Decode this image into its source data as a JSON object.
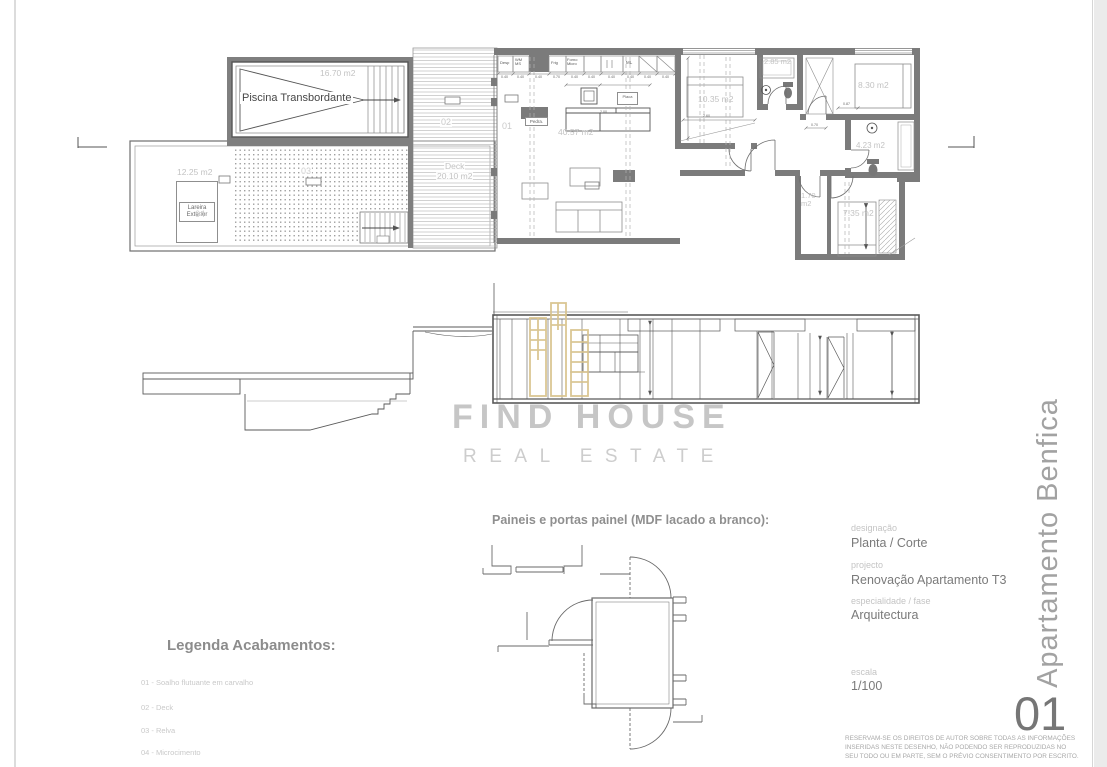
{
  "colors": {
    "watermark_gold": "#d9c48f",
    "wall_gray": "#7b7b7b",
    "line_dark": "#555555",
    "label_light": "#c3c3c3"
  },
  "watermark": {
    "brand_line1": "FIND HOUSE",
    "brand_line2": "REAL ESTATE"
  },
  "sheet": {
    "number": "01",
    "project_vertical": "Apartamento Benfica"
  },
  "title_block": {
    "designacao_label": "designação",
    "designacao_value": "Planta / Corte",
    "projecto_label": "projecto",
    "projecto_value": "Renovação Apartamento T3",
    "especialidade_label": "especialidade / fase",
    "especialidade_value": "Arquitectura",
    "escala_label": "escala",
    "escala_value": "1/100",
    "copyright": [
      "RESERVAM-SE OS DIREITOS DE AUTOR SOBRE TODAS AS INFORMAÇÕES",
      "INSERIDAS NESTE DESENHO, NÃO PODENDO SER REPRODUZIDAS NO",
      "SEU TODO OU EM PARTE, SEM O PRÉVIO CONSENTIMENTO POR ESCRITO."
    ]
  },
  "legend": {
    "heading": "Legenda Acabamentos:",
    "items": [
      "01 - Soalho flutuante em carvalho",
      "02 - Deck",
      "03 - Relva",
      "04 - Microcimento"
    ]
  },
  "panels": {
    "heading": "Paineis e portas painel (MDF lacado a branco):"
  },
  "plan": {
    "labels": {
      "piscina": "Piscina Transbordante",
      "piscina_area": "16.70 m2",
      "terraco_area": "12.25 m2",
      "terraco_code": "04",
      "lareira": "Lareira\nExterior",
      "relva_code": "03",
      "deck_code": "02",
      "deck_name": "Deck",
      "deck_area": "20.10 m2",
      "sala_code": "01",
      "sala_area": "40.57 m2",
      "quarto1_area": "10.35 m2",
      "wc1_area": "2.85 m2",
      "quarto2_area": "8.30 m2",
      "wc2_area": "4.23 m2",
      "arrumo_area": "1.70\nm2",
      "quarto3_area": "7.35 m2",
      "pedra": "Pedra.",
      "placa": "Placa"
    },
    "kitchen_units": {
      "desp": "Desp",
      "wm": "WM\nMS",
      "frig": "Frig",
      "forno": "Forno\nMicro",
      "ml": "ML"
    },
    "dims": {
      "d040": "0.40",
      "d070": "0.70",
      "d200": "2.00",
      "d260": "2.60",
      "d087": "0.87"
    }
  }
}
